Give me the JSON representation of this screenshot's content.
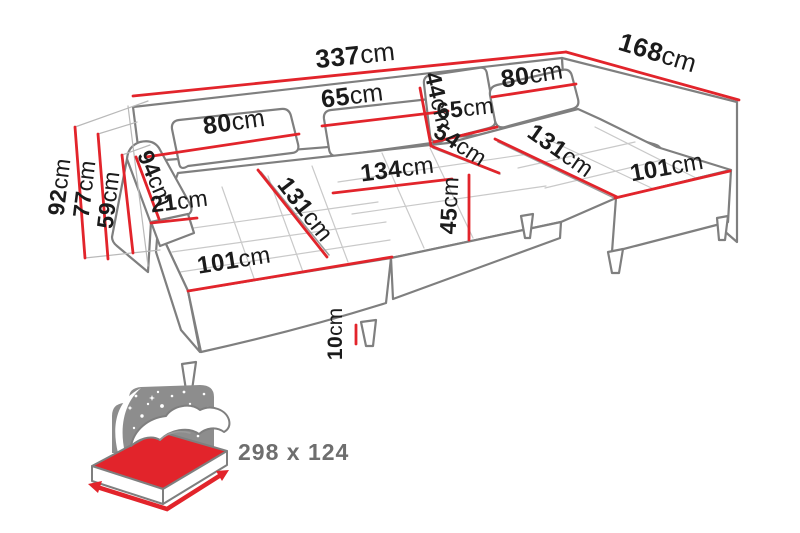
{
  "figure_type": "sofa-dimension-diagram",
  "colors": {
    "dimension_red": "#e2242b",
    "outline_gray": "#7f7f7f",
    "label_black": "#1b1b1b",
    "icon_gray": "#8d8d8d",
    "sleep_text_gray": "#6e6e6e"
  },
  "dimensions": [
    {
      "name": "total-width",
      "value": "337",
      "unit": "cm"
    },
    {
      "name": "side-depth",
      "value": "168",
      "unit": "cm"
    },
    {
      "name": "total-height",
      "value": "92",
      "unit": "cm"
    },
    {
      "name": "backrest-height",
      "value": "77",
      "unit": "cm"
    },
    {
      "name": "armrest-height",
      "value": "59",
      "unit": "cm"
    },
    {
      "name": "armrest-length",
      "value": "94",
      "unit": "cm"
    },
    {
      "name": "armrest-width",
      "value": "21",
      "unit": "cm"
    },
    {
      "name": "back-cushion-left-width",
      "value": "80",
      "unit": "cm"
    },
    {
      "name": "back-cushion-center-width",
      "value": "65",
      "unit": "cm"
    },
    {
      "name": "corner-cushion-height",
      "value": "44",
      "unit": "cm"
    },
    {
      "name": "corner-cushion-width",
      "value": "65",
      "unit": "cm"
    },
    {
      "name": "back-cushion-right-width",
      "value": "80",
      "unit": "cm"
    },
    {
      "name": "corner-seat-width",
      "value": "54",
      "unit": "cm"
    },
    {
      "name": "center-seat-width",
      "value": "134",
      "unit": "cm"
    },
    {
      "name": "seat-height",
      "value": "45",
      "unit": "cm"
    },
    {
      "name": "left-chaise-length",
      "value": "131",
      "unit": "cm"
    },
    {
      "name": "left-chaise-width",
      "value": "101",
      "unit": "cm"
    },
    {
      "name": "right-chaise-length",
      "value": "131",
      "unit": "cm"
    },
    {
      "name": "right-chaise-width",
      "value": "101",
      "unit": "cm"
    },
    {
      "name": "leg-height",
      "value": "10",
      "unit": "cm"
    }
  ],
  "sleeping_area": {
    "icon": "sleeping-function-bed-icon",
    "label": "298 x 124"
  }
}
